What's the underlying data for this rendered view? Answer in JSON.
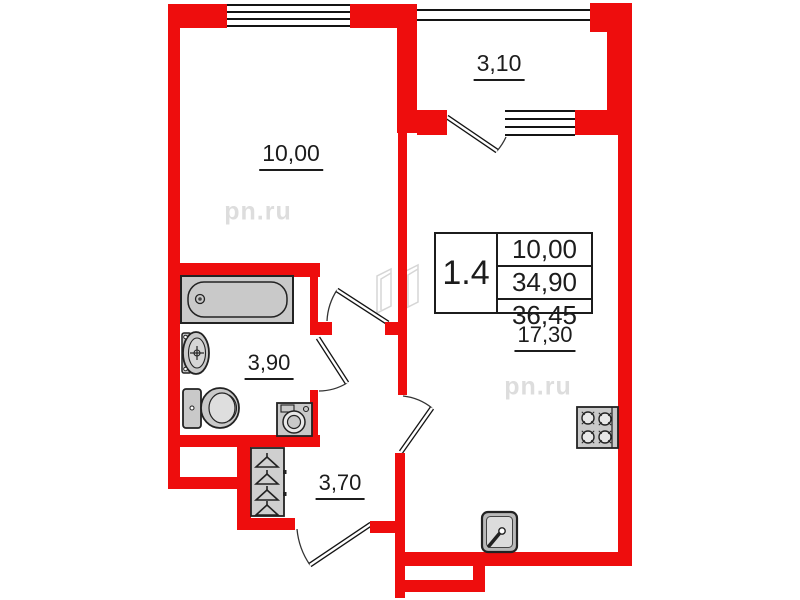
{
  "plan": {
    "unit_card": {
      "unit_number": "1.4",
      "rows": [
        "10,00",
        "34,90",
        "36,45"
      ]
    },
    "room_labels": {
      "living": "10,00",
      "balcony": "3,10",
      "bathroom": "3,90",
      "hallway": "3,70",
      "kitchen_living": "17,30"
    },
    "watermark": {
      "text": "pn.ru"
    },
    "colors": {
      "wall_red": "#ee0d0d",
      "fixture_gray": "#c9c9c9",
      "line_black": "#1a1a1a",
      "watermark_gray": "#dddddd"
    },
    "fixtures": [
      "bathtub",
      "sink",
      "toilet",
      "washing-machine",
      "wardrobe",
      "hangers",
      "stove",
      "kitchen-sink"
    ]
  }
}
